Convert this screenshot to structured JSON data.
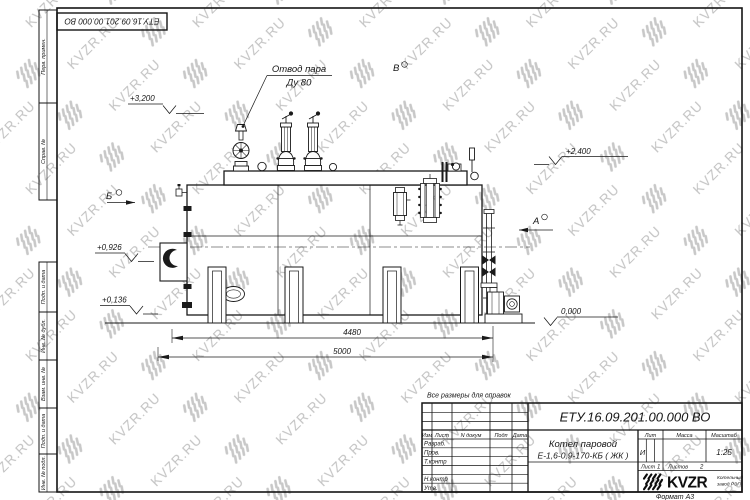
{
  "watermark": {
    "text": "KVZR.RU"
  },
  "top_stamp": {
    "doc_number": "ЕТУ.16.09.201.00.000  ВО"
  },
  "margin_columns": {
    "perv_primen": "Перв. примен.",
    "sprav_no": "Справ. №",
    "podp_data_1": "Подп. и дата",
    "inv_no_dubl": "Инв. № дубл.",
    "vzam_inv_no": "Взам. инв. №",
    "podp_data_2": "Подп. и дата",
    "inv_no_podl": "Инв. № подл."
  },
  "drawing": {
    "note": "Все размеры для справок",
    "steam_outlet": {
      "line1": "Отвод пара",
      "line2": "Ду 80"
    },
    "views": {
      "a": "А",
      "b": "Б",
      "v": "В"
    },
    "elevations": {
      "e3200": "+3,200",
      "e2400": "+2,400",
      "e0926": "+0,926",
      "e0136": "+0,136",
      "e0": "0,000"
    },
    "dimensions": {
      "frame_length": "4480",
      "overall_length": "5000"
    }
  },
  "title_block": {
    "doc_number": "ЕТУ.16.09.201.00.000  ВО",
    "product_name": "Котел паровой",
    "product_type": "Е-1,6-0,9-170-КБ ( ЖК )",
    "columns": {
      "izm": "Изм",
      "list": "Лист",
      "n_dokum": "N докум",
      "podp": "Подп",
      "data": "Дата"
    },
    "roles": {
      "razrab": "Разраб.",
      "prov": "Пров.",
      "t_kontr": "Т.контр",
      "n_kontr": "Н.контр",
      "utv": "Утв."
    },
    "lit": {
      "label": "Лит",
      "value": "И"
    },
    "massa": {
      "label": "Масса"
    },
    "masshtab": {
      "label": "Масштаб",
      "value": "1:25"
    },
    "sheet": {
      "label": "Лист",
      "value": "1"
    },
    "sheets": {
      "label": "Листов",
      "value": "2"
    },
    "logo": {
      "name": "KVZR",
      "sub1": "Котельный",
      "sub2": "завод РЭП"
    },
    "format": "Формат А3"
  }
}
